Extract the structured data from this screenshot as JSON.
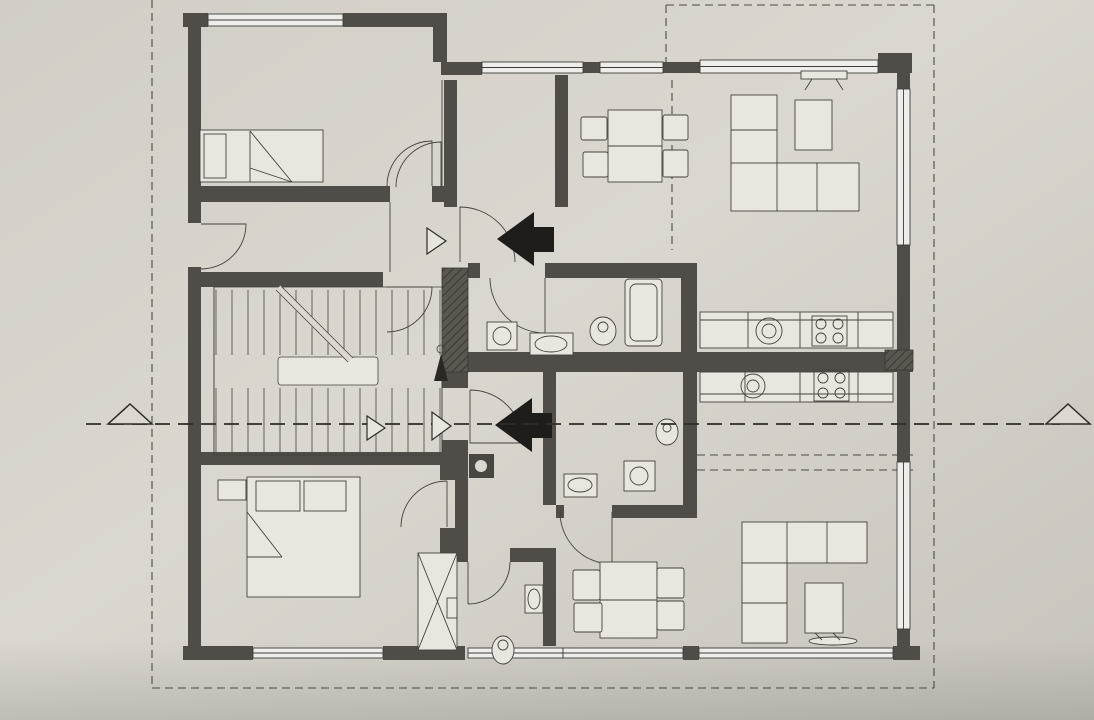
{
  "document": {
    "kind": "architectural floor plan (scanned photo)",
    "language": "Croatian"
  },
  "rooms": [
    {
      "name": "SPAVAĆA SOBA",
      "area": "P=10.87 m²",
      "nx": 348,
      "ny": 44,
      "ax": 341,
      "ay": 62
    },
    {
      "name": "ULAZNI PROSTOR",
      "area": "P=4.51 m²",
      "nx": 308,
      "ny": 239,
      "ax": 293,
      "ay": 258
    },
    {
      "name": "STUBIŠTE",
      "area": "P=10,63 m²",
      "nx": 414,
      "ny": 344,
      "ax": 420,
      "ay": 361
    },
    {
      "name": "PREDPROSTOR",
      "area": "P=5.38 m²",
      "nx": 508,
      "ny": 175,
      "ax": 506,
      "ay": 192
    },
    {
      "name": "KUPAONICA",
      "area": "P=4.85 m²",
      "nx": 594,
      "ny": 291,
      "ax": 591,
      "ay": 310
    },
    {
      "name": "KUHINJA, BLAGOVANJE I DN. BORAVAK",
      "area": "P=22.89 m²",
      "nx": 800,
      "ny": 232,
      "ax": 746,
      "ay": 255
    },
    {
      "name": "KUPAONICA",
      "area": "P=4.03 m²",
      "nx": 604,
      "ny": 426,
      "ax": 603,
      "ay": 445
    },
    {
      "name": "KUHINJA, BLAGOVANJE I DN. BORAVAK",
      "area": "P=22.84 m²",
      "nx": 808,
      "ny": 479,
      "ax": 749,
      "ay": 500
    },
    {
      "name": "PREDPROSTOR",
      "area": "P=4.38 m²",
      "nx": 478,
      "ny": 489,
      "ax": 478,
      "ay": 506
    },
    {
      "name": "WC",
      "area": "P=2.88 m²",
      "nx": 486,
      "ny": 611,
      "ax": 503,
      "ay": 631
    },
    {
      "name": "SPAVAĆA SOBA",
      "area": "P=13.90 m²",
      "nx": 264,
      "ny": 624,
      "ax": 257,
      "ay": 644
    }
  ],
  "level_marker": {
    "t": "+0,20",
    "x": 629,
    "y": 244
  },
  "stair_notes": [
    {
      "t": "16x28",
      "x": 354,
      "y": 315
    },
    {
      "t": "17x16.5",
      "x": 357,
      "y": 334
    },
    {
      "t": "16x28",
      "x": 302,
      "y": 416
    },
    {
      "t": "17x16.5",
      "x": 306,
      "y": 436
    }
  ],
  "section_markers": [
    {
      "t": "A1",
      "x": 409,
      "y": 241,
      "k": "marker"
    },
    {
      "t": "A2",
      "x": 414,
      "y": 430,
      "k": "marker"
    },
    {
      "t": "A",
      "x": 124,
      "y": 452,
      "k": "section"
    },
    {
      "t": "A",
      "x": 1070,
      "y": 452,
      "k": "section"
    }
  ],
  "dims": [
    {
      "t": "350",
      "x": 304,
      "y": 98
    },
    {
      "t": "40",
      "x": 421,
      "y": 98
    },
    {
      "t": "25",
      "x": 438,
      "y": 98
    },
    {
      "t": "10",
      "x": 452,
      "y": 95,
      "r": -90
    },
    {
      "t": "410",
      "x": 314,
      "y": 216
    },
    {
      "t": "415",
      "x": 327,
      "y": 297
    },
    {
      "t": "25",
      "x": 177,
      "y": 299
    },
    {
      "t": "25",
      "x": 446,
      "y": 296
    },
    {
      "t": "30",
      "x": 216,
      "y": 397
    },
    {
      "t": "290",
      "x": 293,
      "y": 397
    },
    {
      "t": "120",
      "x": 415,
      "y": 395
    },
    {
      "t": "30",
      "x": 457,
      "y": 397
    },
    {
      "t": "177",
      "x": 503,
      "y": 94
    },
    {
      "t": "345",
      "x": 541,
      "y": 294
    },
    {
      "t": "140",
      "x": 511,
      "y": 393
    },
    {
      "t": "10",
      "x": 555,
      "y": 393
    },
    {
      "t": "210",
      "x": 621,
      "y": 391
    },
    {
      "t": "40",
      "x": 483,
      "y": 419
    },
    {
      "t": "548",
      "x": 728,
      "y": 92
    },
    {
      "t": "365",
      "x": 788,
      "y": 281
    },
    {
      "t": "25",
      "x": 907,
      "y": 281
    },
    {
      "t": "350",
      "x": 801,
      "y": 389
    },
    {
      "t": "25",
      "x": 907,
      "y": 385
    },
    {
      "t": "365",
      "x": 793,
      "y": 512
    },
    {
      "t": "205",
      "x": 620,
      "y": 515
    },
    {
      "t": "155",
      "x": 502,
      "y": 518
    },
    {
      "t": "10",
      "x": 456,
      "y": 516,
      "r": -90
    },
    {
      "t": "10",
      "x": 556,
      "y": 515,
      "r": -90
    },
    {
      "t": "450",
      "x": 322,
      "y": 522
    },
    {
      "t": "160",
      "x": 512,
      "y": 210
    },
    {
      "t": "30",
      "x": 543,
      "y": 683,
      "r": -90
    },
    {
      "t": "30",
      "x": 646,
      "y": 683,
      "r": -90
    },
    {
      "t": "165",
      "x": 379,
      "y": 79,
      "r": -90
    },
    {
      "t": "10",
      "x": 379,
      "y": 126,
      "r": -90
    },
    {
      "t": "90",
      "x": 379,
      "y": 158,
      "r": -90
    },
    {
      "t": "30",
      "x": 379,
      "y": 192,
      "r": -90
    },
    {
      "t": "110",
      "x": 384,
      "y": 239,
      "r": -90
    },
    {
      "t": "25",
      "x": 384,
      "y": 263,
      "r": -90
    },
    {
      "t": "120",
      "x": 386,
      "y": 319,
      "r": -90
    },
    {
      "t": "50",
      "x": 387,
      "y": 371,
      "r": -90
    },
    {
      "t": "115",
      "x": 386,
      "y": 419,
      "r": -90
    },
    {
      "t": "30",
      "x": 530,
      "y": 70,
      "r": -90
    },
    {
      "t": "10",
      "x": 561,
      "y": 92,
      "r": -90
    },
    {
      "t": "315",
      "x": 525,
      "y": 187,
      "r": -90
    },
    {
      "t": "145",
      "x": 533,
      "y": 318,
      "r": -90
    },
    {
      "t": "10",
      "x": 676,
      "y": 292,
      "r": -90
    },
    {
      "t": "25",
      "x": 533,
      "y": 369,
      "r": -90
    },
    {
      "t": "25",
      "x": 640,
      "y": 364,
      "r": -90
    },
    {
      "t": "210",
      "x": 641,
      "y": 440,
      "r": -90
    },
    {
      "t": "40",
      "x": 512,
      "y": 465,
      "r": -90
    },
    {
      "t": "310",
      "x": 541,
      "y": 467,
      "r": -90
    },
    {
      "t": "10",
      "x": 684,
      "y": 390,
      "r": -90
    },
    {
      "t": "210",
      "x": 387,
      "y": 533,
      "r": -90
    },
    {
      "t": "25",
      "x": 389,
      "y": 606,
      "r": -90
    },
    {
      "t": "75",
      "x": 389,
      "y": 635,
      "r": -90
    },
    {
      "t": "30",
      "x": 389,
      "y": 668,
      "r": -90
    },
    {
      "t": "190",
      "x": 532,
      "y": 616,
      "r": -90
    },
    {
      "t": "290",
      "x": 644,
      "y": 590,
      "r": -90
    },
    {
      "t": "1155",
      "x": 25,
      "y": 362,
      "r": -90
    },
    {
      "t": "745",
      "x": 43,
      "y": 237,
      "r": -90
    },
    {
      "t": "105",
      "x": 65,
      "y": 239,
      "r": -90
    },
    {
      "t": "110",
      "x": 87,
      "y": 238,
      "r": -90
    },
    {
      "t": "215",
      "x": 69,
      "y": 338,
      "r": -90
    },
    {
      "t": "330",
      "x": 61,
      "y": 109,
      "r": -90
    },
    {
      "t": "265",
      "x": 85,
      "y": 109,
      "r": -90
    },
    {
      "t": "30",
      "x": 80,
      "y": 17,
      "r": -90
    },
    {
      "t": "255",
      "x": 102,
      "y": 17,
      "r": -90
    },
    {
      "t": "405",
      "x": 111,
      "y": 150,
      "r": -90
    },
    {
      "t": "30",
      "x": 79,
      "y": 199,
      "r": -90
    },
    {
      "t": "30",
      "x": 93,
      "y": 198,
      "r": -90
    },
    {
      "t": "25",
      "x": 83,
      "y": 275,
      "r": -90
    },
    {
      "t": "25",
      "x": 117,
      "y": 275,
      "r": -90
    },
    {
      "t": "285",
      "x": 94,
      "y": 376,
      "r": -90
    },
    {
      "t": "290",
      "x": 121,
      "y": 378,
      "r": -90
    },
    {
      "t": "80",
      "x": 71,
      "y": 429,
      "r": -90
    },
    {
      "t": "15",
      "x": 65,
      "y": 456,
      "r": -90
    },
    {
      "t": "30",
      "x": 105,
      "y": 467,
      "r": -90
    },
    {
      "t": "25",
      "x": 123,
      "y": 471,
      "r": -90
    },
    {
      "t": "370",
      "x": 43,
      "y": 573,
      "r": -90
    },
    {
      "t": "370",
      "x": 64,
      "y": 572,
      "r": -90
    },
    {
      "t": "310",
      "x": 91,
      "y": 573,
      "r": -90
    },
    {
      "t": "310",
      "x": 119,
      "y": 573,
      "r": -90
    },
    {
      "t": "40",
      "x": 35,
      "y": 700,
      "r": -90
    },
    {
      "t": "40",
      "x": 59,
      "y": 698,
      "r": -90
    },
    {
      "t": "30",
      "x": 78,
      "y": 691,
      "r": -90
    },
    {
      "t": "10",
      "x": 85,
      "y": 698,
      "r": -90
    },
    {
      "t": "30",
      "x": 92,
      "y": 705,
      "r": -90
    },
    {
      "t": "5",
      "x": 108,
      "y": 690,
      "r": -90
    },
    {
      "t": "40",
      "x": 115,
      "y": 699,
      "r": -90
    },
    {
      "t": "25",
      "x": 122,
      "y": 708,
      "r": -90
    },
    {
      "t": "65",
      "x": 962,
      "y": 31,
      "r": -90
    },
    {
      "t": "25",
      "x": 961,
      "y": 57,
      "r": -90
    },
    {
      "t": "65",
      "x": 987,
      "y": 30,
      "r": -90
    },
    {
      "t": "25",
      "x": 986,
      "y": 57,
      "r": -90
    },
    {
      "t": "60",
      "x": 1012,
      "y": 30,
      "r": -90
    },
    {
      "t": "30",
      "x": 1011,
      "y": 59,
      "r": -90
    },
    {
      "t": "90",
      "x": 1035,
      "y": 20,
      "r": -90
    },
    {
      "t": "30",
      "x": 1036,
      "y": 47,
      "r": -90
    },
    {
      "t": "90",
      "x": 1058,
      "y": 20,
      "r": -90
    },
    {
      "t": "470",
      "x": 962,
      "y": 207,
      "r": -90
    },
    {
      "t": "470",
      "x": 987,
      "y": 207,
      "r": -90
    },
    {
      "t": "470",
      "x": 1012,
      "y": 206,
      "r": -90
    },
    {
      "t": "380",
      "x": 1040,
      "y": 177,
      "r": -90
    },
    {
      "t": "25",
      "x": 961,
      "y": 355,
      "r": -90
    },
    {
      "t": "25",
      "x": 986,
      "y": 355,
      "r": -90
    },
    {
      "t": "25",
      "x": 1011,
      "y": 354,
      "r": -90
    },
    {
      "t": "1025",
      "x": 1062,
      "y": 353,
      "r": -90
    },
    {
      "t": "1155",
      "x": 1085,
      "y": 345,
      "r": -90
    },
    {
      "t": "110",
      "x": 966,
      "y": 393,
      "r": -90
    },
    {
      "t": "97",
      "x": 992,
      "y": 393,
      "r": -90
    },
    {
      "t": "25",
      "x": 973,
      "y": 437,
      "r": -90
    },
    {
      "t": "50",
      "x": 994,
      "y": 437,
      "r": -90
    },
    {
      "t": "263",
      "x": 1046,
      "y": 372,
      "r": -90
    },
    {
      "t": "470",
      "x": 1021,
      "y": 502,
      "r": -90
    },
    {
      "t": "335",
      "x": 971,
      "y": 545,
      "r": -90
    },
    {
      "t": "322",
      "x": 994,
      "y": 545,
      "r": -90
    },
    {
      "t": "322",
      "x": 1052,
      "y": 545,
      "r": -90
    },
    {
      "t": "25",
      "x": 966,
      "y": 648,
      "r": -90
    },
    {
      "t": "15",
      "x": 966,
      "y": 657,
      "r": -90
    },
    {
      "t": "25",
      "x": 966,
      "y": 666,
      "r": -90
    },
    {
      "t": "5",
      "x": 966,
      "y": 640,
      "r": -90
    },
    {
      "t": "5",
      "x": 988,
      "y": 641,
      "r": -90
    },
    {
      "t": "40",
      "x": 988,
      "y": 651,
      "r": -90
    },
    {
      "t": "25",
      "x": 988,
      "y": 661,
      "r": -90
    },
    {
      "t": "30",
      "x": 1018,
      "y": 647,
      "r": -90
    },
    {
      "t": "10",
      "x": 1018,
      "y": 656,
      "r": -90
    },
    {
      "t": "30",
      "x": 1018,
      "y": 664,
      "r": -90
    },
    {
      "t": "40",
      "x": 1046,
      "y": 650,
      "r": -90
    },
    {
      "t": "30",
      "x": 1046,
      "y": 660,
      "r": -90
    },
    {
      "t": "40",
      "x": 1070,
      "y": 672,
      "r": -90
    },
    {
      "t": "40",
      "x": 1076,
      "y": 683,
      "r": -90
    }
  ]
}
